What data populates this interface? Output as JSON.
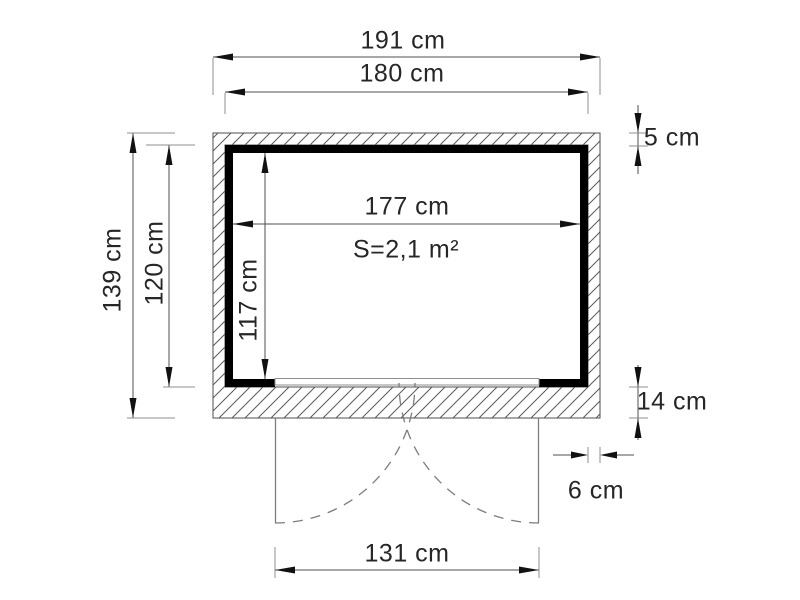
{
  "drawing": {
    "type": "floor-plan",
    "area_label": "S=2,1 m²",
    "dims": {
      "outer_width": "191 cm",
      "body_width": "180 cm",
      "inner_width": "177 cm",
      "outer_depth": "139 cm",
      "body_depth": "120 cm",
      "inner_depth": "117 cm",
      "top_wall_thickness": "5 cm",
      "front_wall_thickness": "14 cm",
      "side_wall_thickness": "6 cm",
      "door_width": "131 cm"
    },
    "colors": {
      "wall": "#000000",
      "dimension_line": "#4f4f4f",
      "extension_line": "#8f8f8f",
      "hatch_line": "#5a5a5a",
      "door_swing": "#7d7d7d",
      "text": "#262626",
      "background": "#ffffff"
    }
  }
}
